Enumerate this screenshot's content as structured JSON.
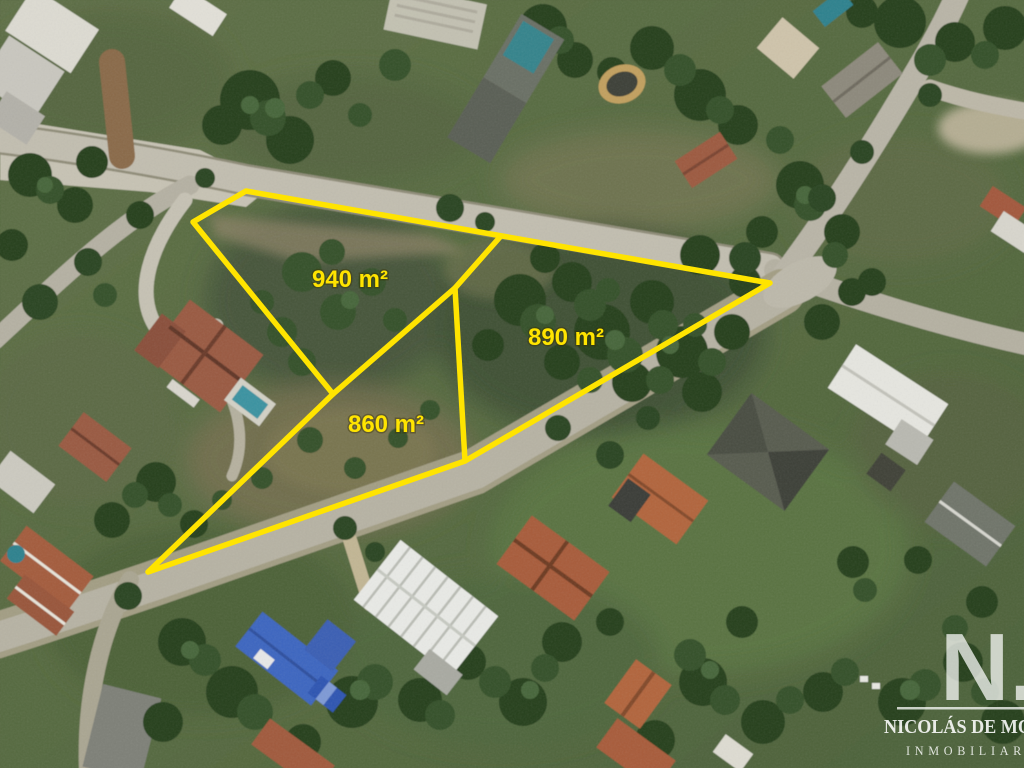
{
  "overlay": {
    "accent_color": "#ffe400",
    "parcels": [
      {
        "area_label": "940 m²",
        "area_m2": 940
      },
      {
        "area_label": "890 m²",
        "area_m2": 890
      },
      {
        "area_label": "860 m²",
        "area_m2": 860
      }
    ]
  },
  "watermark": {
    "monogram": "N.",
    "agency_name": "NICOLÁS DE MO",
    "agency_tagline": "INMOBILIAR",
    "color": "#ffffff"
  }
}
